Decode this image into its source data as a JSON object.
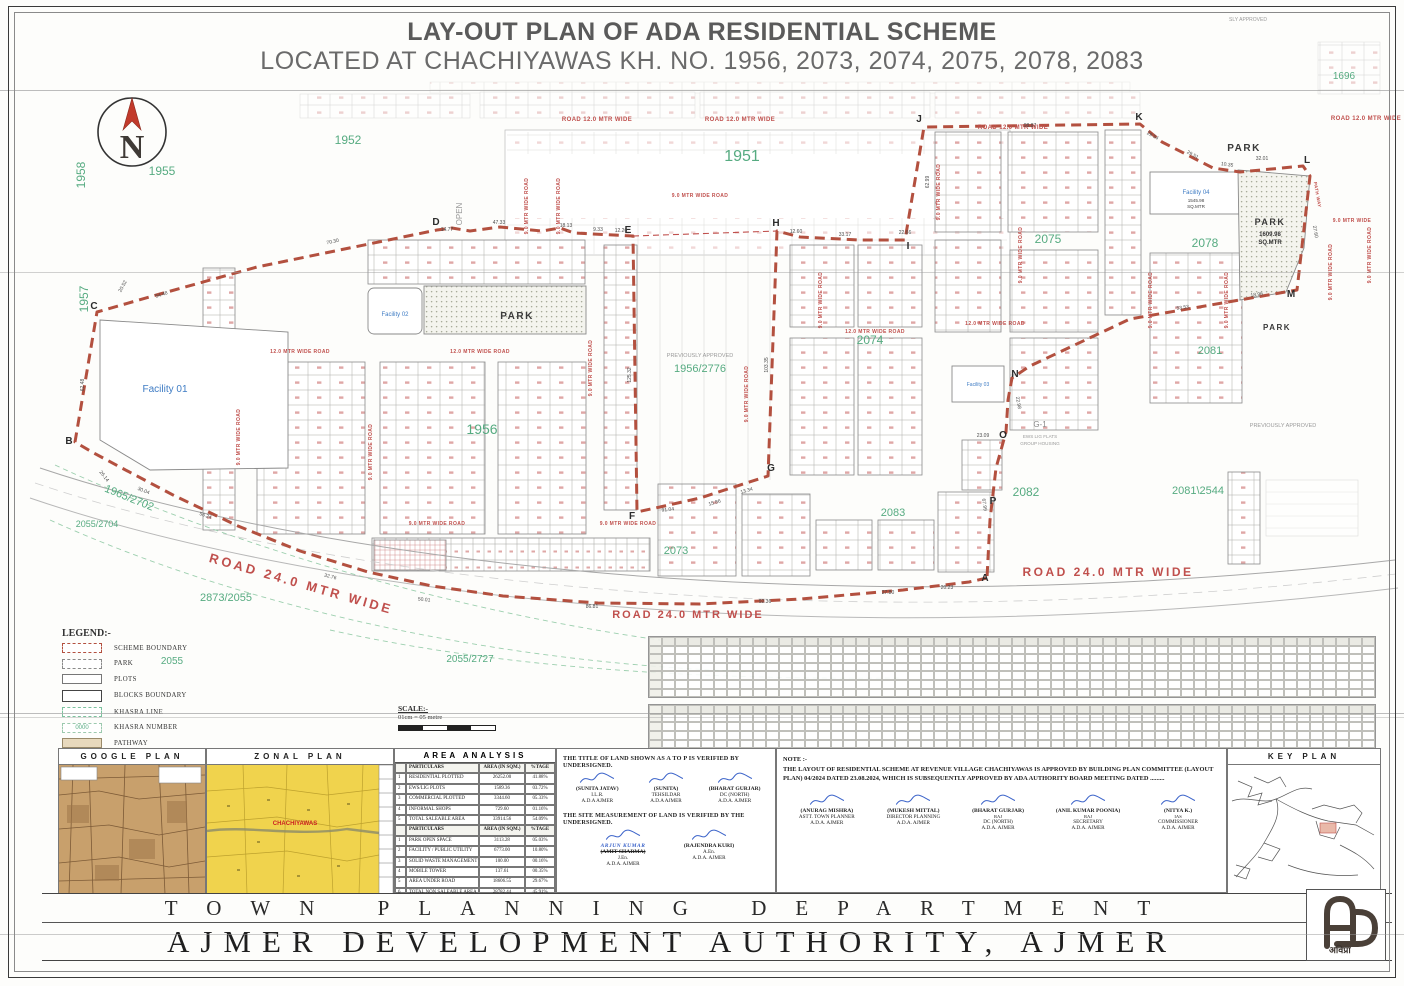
{
  "title": {
    "line1": "LAY-OUT PLAN OF ADA RESIDENTIAL SCHEME",
    "line2": "LOCATED AT CHACHIYAWAS KH. NO. 1956, 2073, 2074, 2075, 2078, 2083"
  },
  "plan": {
    "north": "N",
    "road12": "ROAD 12.0 MTR WIDE",
    "road12b": "12.0 MTR WIDE ROAD",
    "road9": "9.0 MTR WIDE ROAD",
    "road9s": "9.0 MTR WIDE",
    "road24": "ROAD 24.0 MTR WIDE",
    "pathway": "PATH WAY",
    "open": "OPEN",
    "previously_approved": "PREVIOUSLY APPROVED",
    "sly_approved": "SLY APPROVED",
    "khasra": {
      "k1958": "1958",
      "k1955": "1955",
      "k1952": "1952",
      "k1951": "1951",
      "k1957": "1957",
      "k1956": "1956",
      "k1956_2776": "1956/2776",
      "k2074": "2074",
      "k2075": "2075",
      "k2078": "2078",
      "k2081": "2081",
      "k2082": "2082",
      "k2083": "2083",
      "k2073": "2073",
      "k1965_2702": "1965/2702",
      "k2055_2704": "2055/2704",
      "k2873_2055": "2873/2055",
      "k2055": "2055",
      "k2055_2727": "2055/2727",
      "k2081_2544": "2081\\2544",
      "k1696": "1696"
    },
    "facilities": {
      "f01": "Facility 01",
      "f02": "Facility 02",
      "f03": "Facility 03",
      "f04": "Facility 04",
      "f04_area": "1545.98",
      "f04_unit": "SQ.MTR",
      "park": "PARK",
      "park_area": "1609.98",
      "park_unit": "SQ.MTR",
      "g1": "G-1",
      "g1_sub": "EWS LIG FLATS",
      "g1_sub2": "GROUP HOUSING"
    },
    "points": [
      "A",
      "B",
      "C",
      "D",
      "E",
      "F",
      "G",
      "H",
      "I",
      "J",
      "K",
      "L",
      "M",
      "N",
      "O",
      "P"
    ],
    "dims": [
      "70.30",
      "20.52",
      "54.48",
      "62.48",
      "26.14",
      "30.04",
      "56.24",
      "32.76",
      "50.01",
      "86.81",
      "92.36",
      "27.80",
      "20.23",
      "14.77",
      "47.33",
      "18.13",
      "9.33",
      "12.20",
      "12.60",
      "33.17",
      "22.66",
      "98.87",
      "29.54",
      "29.51",
      "10.35",
      "32.01",
      "27.60",
      "53.53",
      "18.96",
      "23.09",
      "22.98",
      "91.04",
      "15.86",
      "13.34",
      "125.32",
      "103.35",
      "62.99",
      "67.99"
    ]
  },
  "legend": {
    "heading": "LEGEND:-",
    "items": [
      "SCHEME BOUNDARY",
      "PARK",
      "PLOTS",
      "BLOCKS BOUNDARY",
      "KHASRA LINE",
      "KHASRA NUMBER",
      "PATHWAY"
    ],
    "khasra_swatch": "0000"
  },
  "scale": {
    "heading": "SCALE:-",
    "text": "01cm = 05 metre"
  },
  "panels": {
    "google": "GOOGLE PLAN",
    "zonal": "ZONAL PLAN",
    "zonal_marker": "CHACHIYAWAS",
    "key": "KEY PLAN"
  },
  "area_analysis": {
    "title": "AREA ANALYSIS",
    "rows": [
      [
        "",
        "PARTICULARS",
        "AREA (IN SQM.)",
        "%TAGE"
      ],
      [
        "1",
        "RESIDENTIAL PLOTTED",
        "26252.00",
        "41.88%"
      ],
      [
        "2",
        "EWS/LIG PLOTS",
        "1589.36",
        "03.72%"
      ],
      [
        "3",
        "COMMERCIAL PLOTTED",
        "3344.60",
        "05.33%"
      ],
      [
        "4",
        "INFORMAL SHOPS",
        "729.60",
        "01.16%"
      ],
      [
        "5",
        "TOTAL SALEABLE AREA",
        "33914.56",
        "54.09%"
      ],
      [
        "",
        "PARTICULARS",
        "AREA (IN SQM.)",
        "%TAGE"
      ],
      [
        "1",
        "PARK OPEN SPACE",
        "3113.28",
        "05.03%"
      ],
      [
        "2",
        "FACILITY / PUBLIC UTILITY",
        "6773.00",
        "10.80%"
      ],
      [
        "3",
        "SOLID WASTE MANAGEMENT",
        "100.00",
        "00.16%"
      ],
      [
        "4",
        "MOBILE TOWER",
        "137.61",
        "00.35%"
      ],
      [
        "5",
        "AREA UNDER ROAD",
        "18606.55",
        "29.67%"
      ],
      [
        "6",
        "TOTAL NON SALEABLE AREA",
        "28782.44",
        "45.91%"
      ],
      [
        "7",
        "TOTAL SCHEME AREA",
        "62706.00",
        "100%"
      ]
    ]
  },
  "verification": {
    "title_text": "THE TITLE OF LAND SHOWN AS A TO P IS VERIFIED BY UNDERSIGNED.",
    "site_text": "THE SITE MEASUREMENT OF LAND IS VERIFIED BY THE UNDERSIGNED.",
    "row1": [
      {
        "name": "(SUNITA JATAV)",
        "role": "I.L.R.",
        "org": "A.D.A AJMER"
      },
      {
        "name": "(SUNITA)",
        "role": "TEHSILDAR",
        "org": "A.D.A AJMER"
      },
      {
        "name": "(BHARAT GURJAR)",
        "role": "DC (NORTH)",
        "org": "A.D.A. AJMER"
      }
    ],
    "row2": [
      {
        "name": "(AMIT SHARMA)",
        "role": "J.En.",
        "org": "A.D.A. AJMER",
        "struck": true,
        "hand": "ARJUN KUMAR"
      },
      {
        "name": "(RAJENDRA KURI)",
        "role": "A.En.",
        "org": "A.D.A. AJMER"
      }
    ]
  },
  "note": {
    "heading": "NOTE :-",
    "text": "THE LAYOUT OF  RESIDENTIAL SCHEME AT REVENUE VILLAGE CHACHIYAWAS IS APPROVED BY BUILDING PLAN COMMITTEE (LAYOUT PLAN) 04/2024 DATED 23.08.2024, WHICH IS SUBSEQUENTLY APPROVED BY ADA AUTHORITY BOARD MEETING DATED ........."
  },
  "approvals": [
    {
      "name": "(ANURAG MISHRA)",
      "role": "ASTT. TOWN PLANNER",
      "org": "A.D.A. AJMER"
    },
    {
      "name": "(MUKESH MITTAL)",
      "role": "DIRECTOR PLANNING",
      "org": "A.D.A. AJMER"
    },
    {
      "name": "(BHARAT GURJAR)",
      "extra": "RAJ",
      "role": "DC (NORTH)",
      "org": "A.D.A. AJMER"
    },
    {
      "name": "(ANIL KUMAR POONIA)",
      "extra": "RAJ",
      "role": "SECRETARY",
      "org": "A.D.A. AJMER"
    },
    {
      "name": "(NITYA K.)",
      "extra": "IAS",
      "role": "COMMISSIONER",
      "org": "A.D.A. AJMER"
    }
  ],
  "footer": {
    "dept": "TOWN PLANNING DEPARTMENT",
    "authority": "AJMER DEVELOPMENT AUTHORITY, AJMER",
    "logo_text": "अविप्रा"
  },
  "plot_schedule": {
    "tables": 2,
    "rows": 7,
    "cols": 56
  },
  "colors": {
    "boundary": "#b3503f",
    "road_text": "#c0504d",
    "khasra": "#56ab81",
    "facility": "#3f7cc4",
    "pathway": "#e8d9bd"
  }
}
